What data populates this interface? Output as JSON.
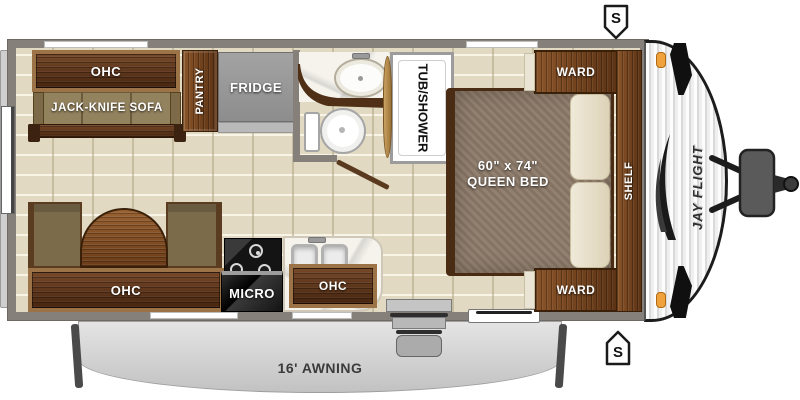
{
  "title": "Jay Flight travel trailer floor plan",
  "labels": {
    "ohc_rear": "OHC",
    "sofa": "JACK-KNIFE SOFA",
    "pantry": "PANTRY",
    "fridge": "FRIDGE",
    "tub_shower": "TUB/SHOWER",
    "ward_top": "WARD",
    "ward_bottom": "WARD",
    "shelf": "SHELF",
    "bed_size": "60\" x 74\"",
    "bed_name": "QUEEN BED",
    "ohc_dinette": "OHC",
    "micro": "MICRO",
    "ohc_kitchen": "OHC",
    "awning": "16' AWNING",
    "speaker": "S",
    "brand": "JAY FLIGHT"
  },
  "colors": {
    "wall": "#86807a",
    "floor": "#e1d9c2",
    "wood_dark": "#5a3419",
    "wood_medium": "#8a5a2e",
    "cushion": "#8d7c5c",
    "mattress": "#8c7a69",
    "pillow": "#ece5d0",
    "appliance_gray": "#9a9a9a",
    "appliance_black": "#161616",
    "awning_gray": "#d5d5d5",
    "accent_orange": "#f0a23c"
  }
}
